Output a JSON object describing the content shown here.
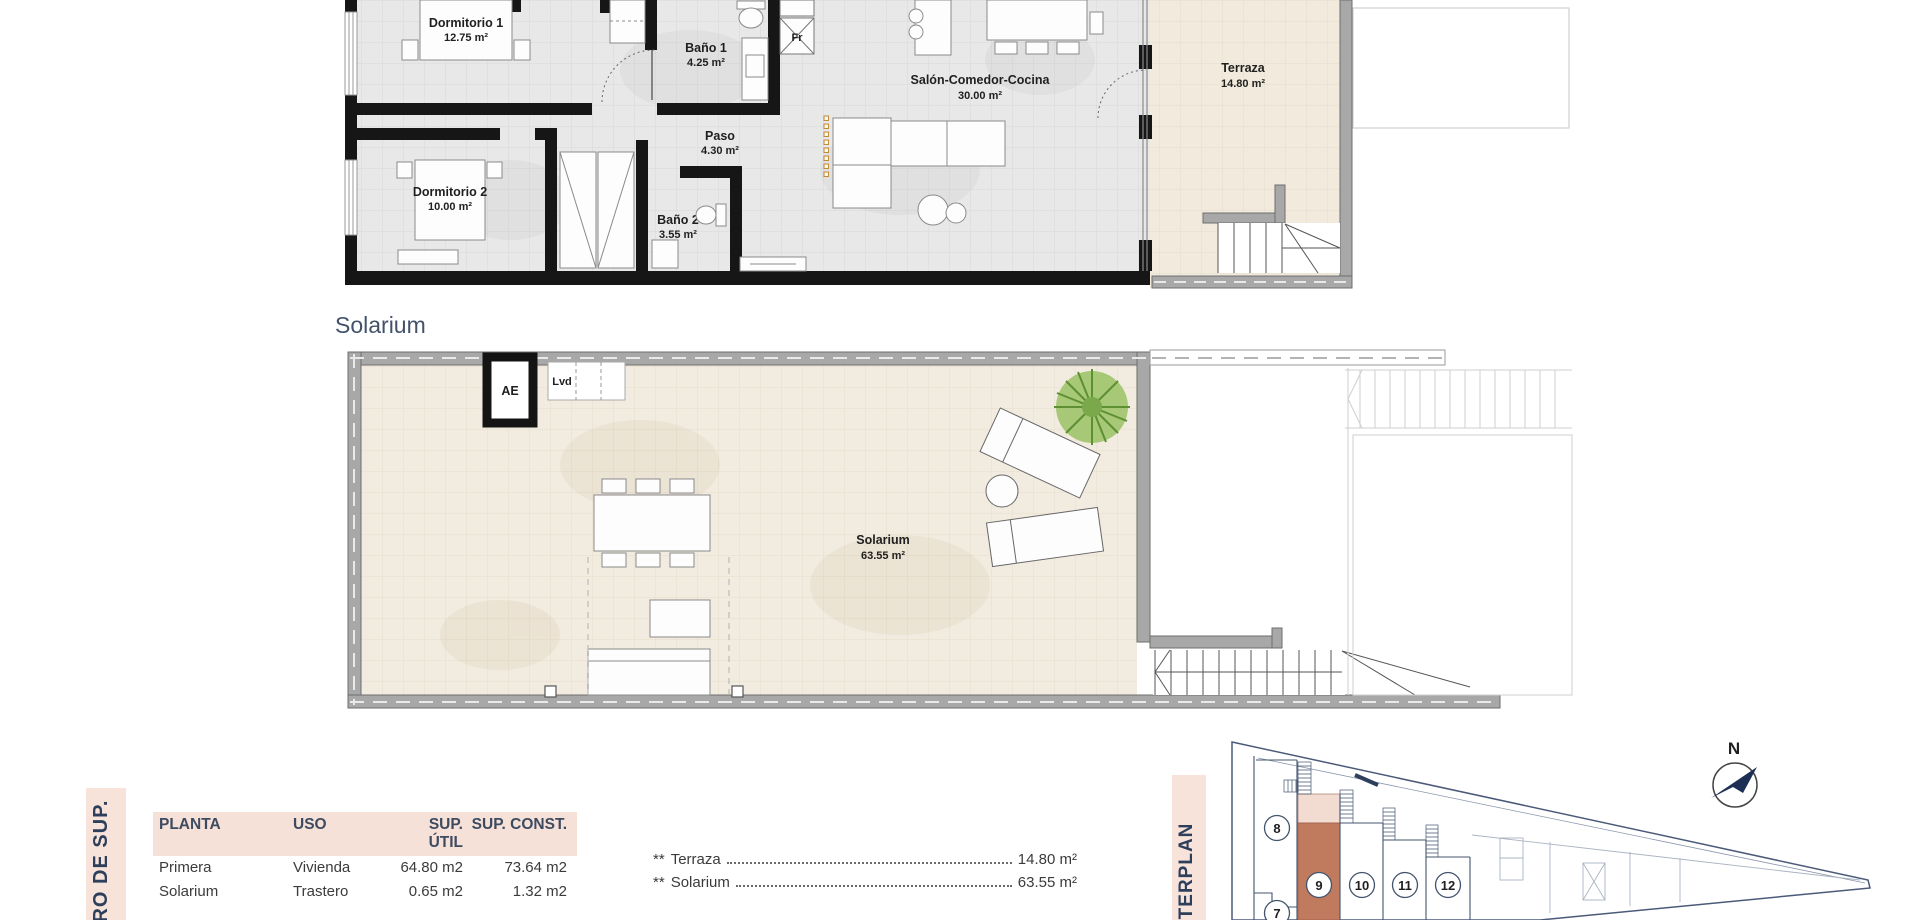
{
  "plan_upper": {
    "rooms": [
      {
        "name": "Dormitorio 1",
        "area": "12.75 m²"
      },
      {
        "name": "Baño 1",
        "area": "4.25 m²"
      },
      {
        "name": "Paso",
        "area": "4.30 m²"
      },
      {
        "name": "Dormitorio 2",
        "area": "10.00 m²"
      },
      {
        "name": "Baño 2",
        "area": "3.55 m²"
      },
      {
        "name": "Salón-Comedor-Cocina",
        "area": "30.00 m²"
      },
      {
        "name": "Terraza",
        "area": "14.80 m²"
      }
    ],
    "labels": {
      "fridge": "Fr"
    }
  },
  "plan_solarium": {
    "heading": "Solarium",
    "room": {
      "name": "Solarium",
      "area": "63.55 m²"
    },
    "labels": {
      "elevator": "AE",
      "laundry": "Lvd"
    }
  },
  "surface_table": {
    "side_label": "DRO DE SUP.",
    "headers": [
      "PLANTA",
      "USO",
      "SUP. ÚTIL",
      "SUP. CONST."
    ],
    "rows": [
      {
        "planta": "Primera",
        "uso": "Vivienda",
        "util": "64.80 m2",
        "konst": "73.64 m2"
      },
      {
        "planta": "Solarium",
        "uso": "Trastero",
        "util": "0.65 m2",
        "konst": "1.32 m2"
      }
    ],
    "notes": [
      {
        "marker": "**",
        "label": "Terraza",
        "value": "14.80 m²"
      },
      {
        "marker": "**",
        "label": "Solarium",
        "value": "63.55 m²"
      }
    ]
  },
  "masterplan": {
    "side_label": "STERPLAN",
    "north_label": "N",
    "units": [
      {
        "n": "7"
      },
      {
        "n": "8"
      },
      {
        "n": "9"
      },
      {
        "n": "10"
      },
      {
        "n": "11"
      },
      {
        "n": "12"
      }
    ],
    "highlighted_unit": "9",
    "colors": {
      "highlight": "#c07a5e",
      "highlight_light": "#f2dcd2",
      "strip_bg": "#f8e3da",
      "navy": "#2e3f5c"
    }
  }
}
